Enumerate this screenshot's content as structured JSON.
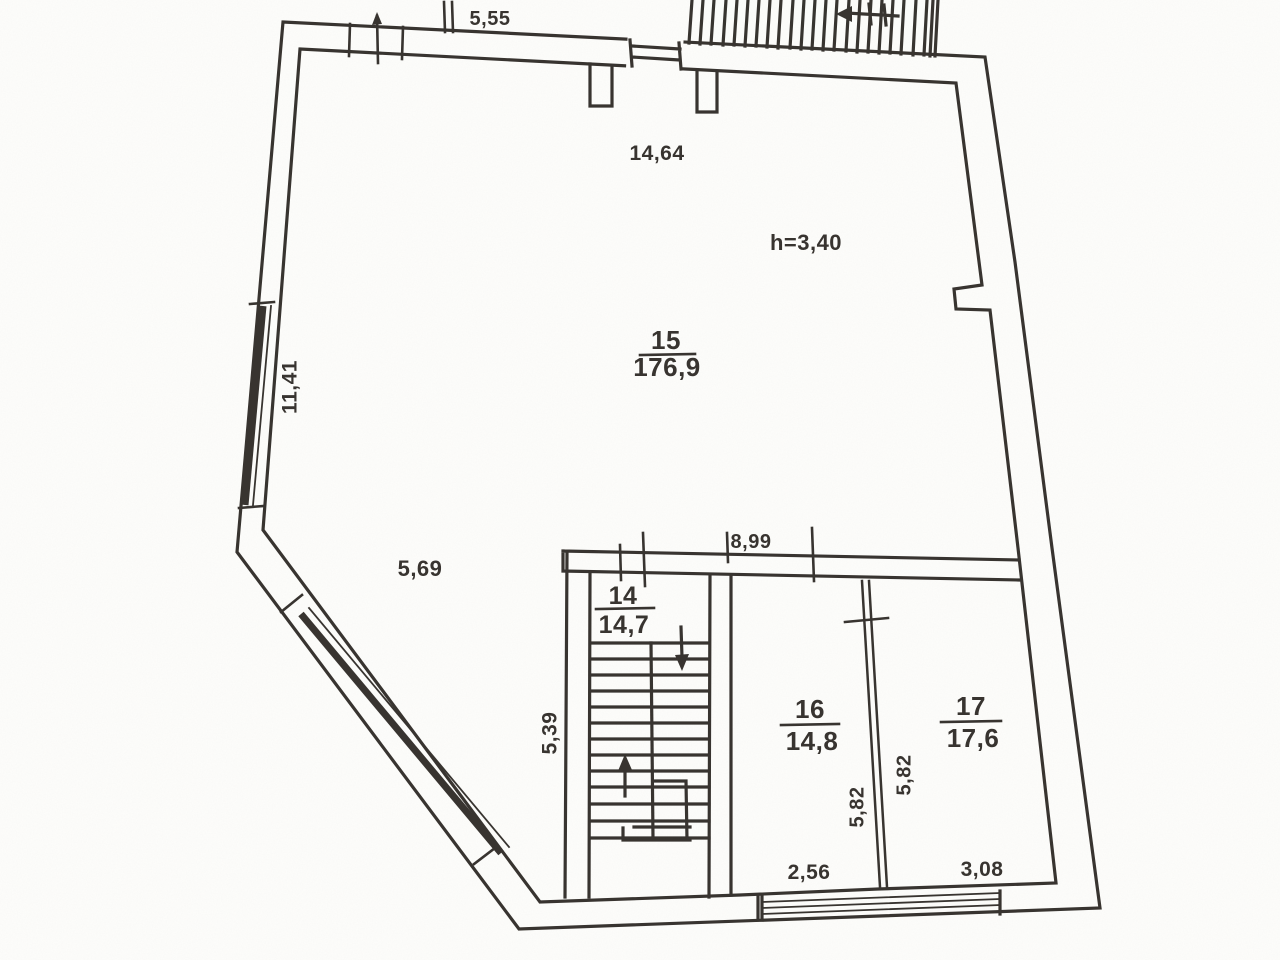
{
  "document": {
    "kind": "scanned-floor-plan",
    "height_note": "h=3,40"
  },
  "colors": {
    "ink": "#37332f",
    "paper": "#fdfdfb"
  },
  "rooms": {
    "r15": {
      "number": "15",
      "area": "176,9"
    },
    "r14": {
      "number": "14",
      "area": "14,7"
    },
    "r16": {
      "number": "16",
      "area": "14,8"
    },
    "r17": {
      "number": "17",
      "area": "17,6"
    }
  },
  "dimensions": {
    "top_exterior": "5,55",
    "hall_width": "14,64",
    "left_wall": "11,41",
    "diagonal_wall": "5,69",
    "lower_block_width": "8,99",
    "stairwell_depth": "5,39",
    "room16_depth": "5,82",
    "room17_depth": "5,82",
    "room16_width": "2,56",
    "room17_width": "3,08"
  }
}
